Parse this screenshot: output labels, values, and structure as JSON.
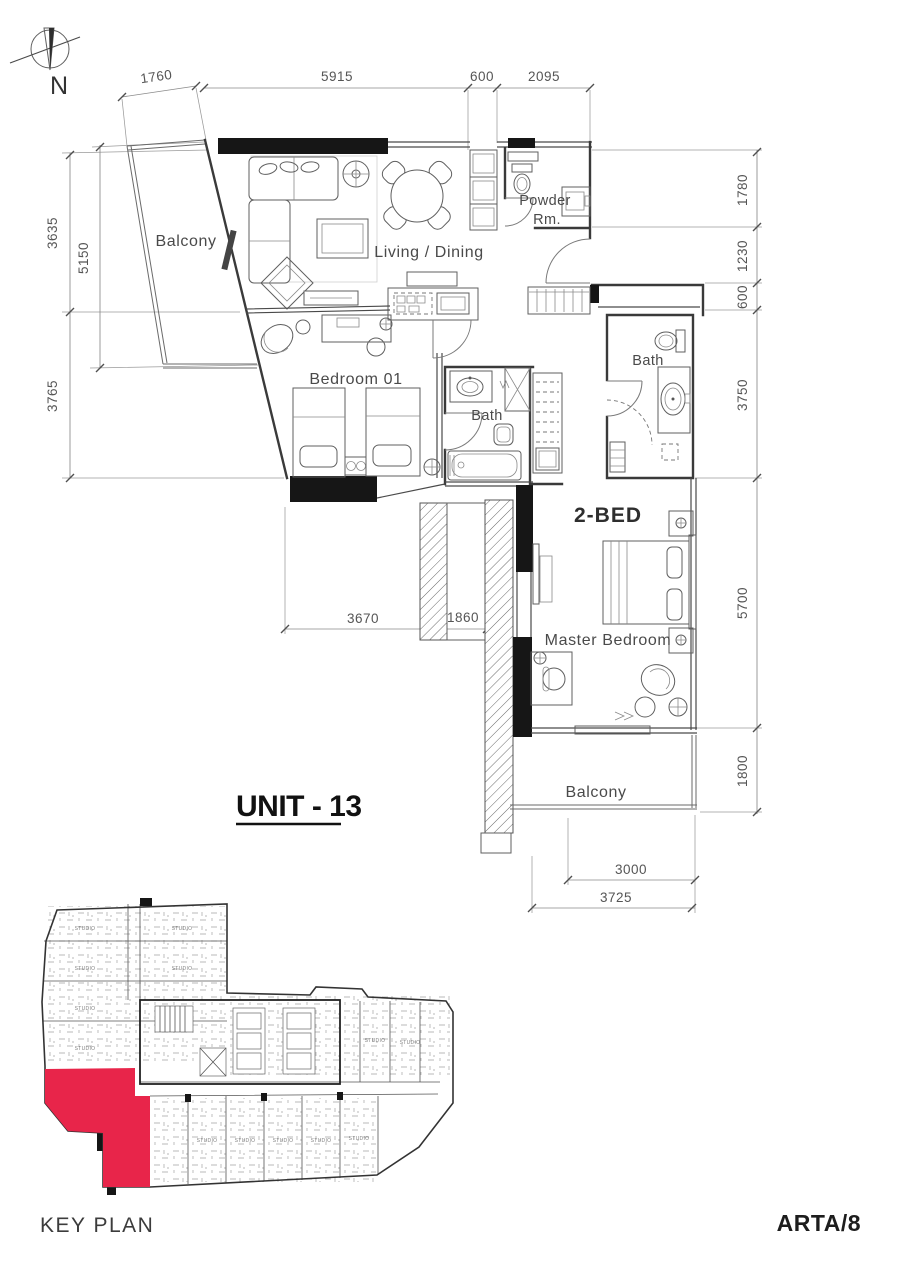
{
  "sheet": {
    "unit_title": "UNIT - 13",
    "key_plan_title": "KEY PLAN",
    "project_code": "ARTA/8"
  },
  "compass": {
    "north_label": "N"
  },
  "rooms": {
    "balcony_top": "Balcony",
    "living_dining": "Living / Dining",
    "powder_line1": "Powder",
    "powder_line2": "Rm.",
    "bedroom_01": "Bedroom 01",
    "bath_1": "Bath",
    "bath_2": "Bath",
    "unit_type": "2-BED",
    "master_bedroom": "Master Bedroom",
    "balcony_bottom": "Balcony"
  },
  "dimensions_mm": {
    "top": [
      "1760",
      "5915",
      "600",
      "2095"
    ],
    "left": [
      "3635",
      "5150",
      "3765"
    ],
    "right": [
      "1780",
      "1230",
      "600",
      "3750",
      "5700",
      "1800"
    ],
    "middle": [
      "3670",
      "1860"
    ],
    "bottom": [
      "3000",
      "3725"
    ]
  },
  "key_plan": {
    "unit_label": "STUDIO",
    "highlight_color": "#e8254a"
  },
  "colors": {
    "wall": "#161616",
    "line": "#4a4a4a",
    "highlight": "#e8254a"
  }
}
